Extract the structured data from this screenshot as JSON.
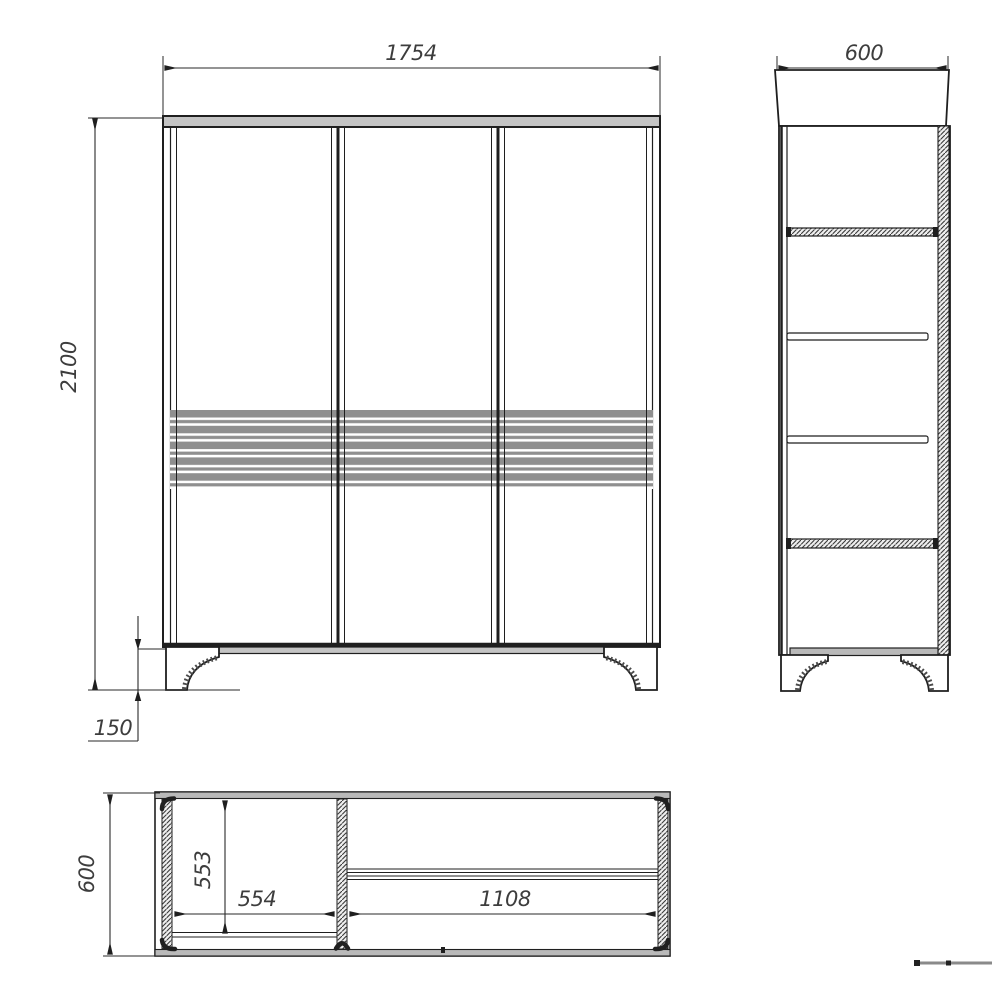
{
  "drawing": {
    "type": "furniture-technical-drawing",
    "subject": "three-door wardrobe orthographic views with dimensions (mm)",
    "views": [
      {
        "id": "front",
        "name": "front view"
      },
      {
        "id": "side",
        "name": "side view"
      },
      {
        "id": "top",
        "name": "top plan view"
      }
    ],
    "dimensions": {
      "front_width": "1754",
      "front_height": "2100",
      "front_leg_height": "150",
      "side_depth": "600",
      "top_depth": "600",
      "top_left_compartment_depth": "553",
      "top_left_compartment_width": "554",
      "top_right_compartment_width": "1108"
    },
    "colors": {
      "line": "#1f1f1f",
      "dim_text": "#3d3d3d",
      "panel_gray": "#c4c4c4",
      "slat_gray": "#8f8f8f",
      "band_gray": "#b9b9b9"
    }
  }
}
